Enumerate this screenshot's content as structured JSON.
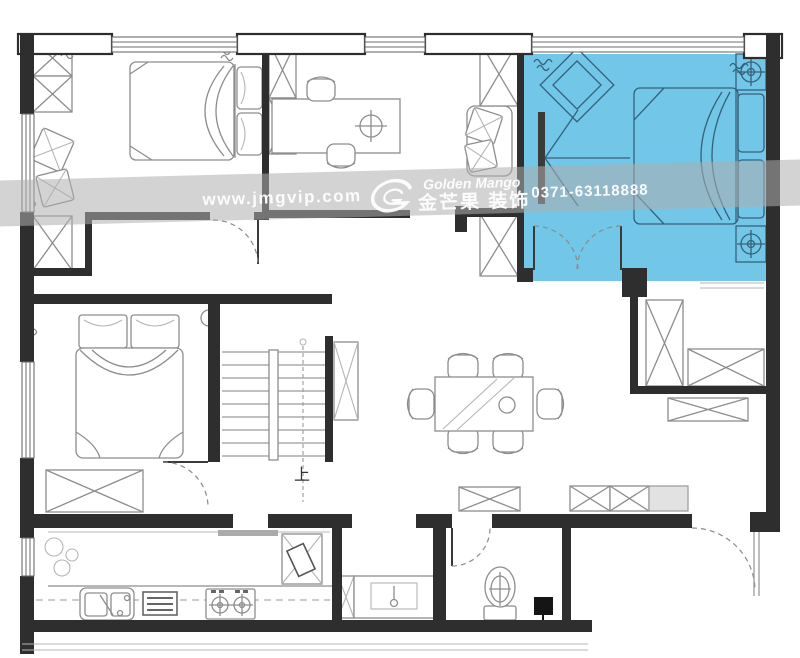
{
  "canvas": {
    "width": 800,
    "height": 658,
    "background": "#ffffff"
  },
  "watermark": {
    "website": "www.jmgvip.com",
    "brand_en": "Golden Mango",
    "brand_cn": "金芒果 装饰",
    "phone": "0371-63118888",
    "band_color": "rgba(174,174,174,0.55)",
    "text_color": "#ffffff",
    "logo": "golden-mango-g-logo"
  },
  "plan": {
    "stairs_label": "上",
    "colors": {
      "highlight_room": "#72c6e8",
      "walls": "#2e2e2e",
      "furniture_lines": "#8d8d8d",
      "highlight_furniture_lines": "#35617a"
    }
  }
}
